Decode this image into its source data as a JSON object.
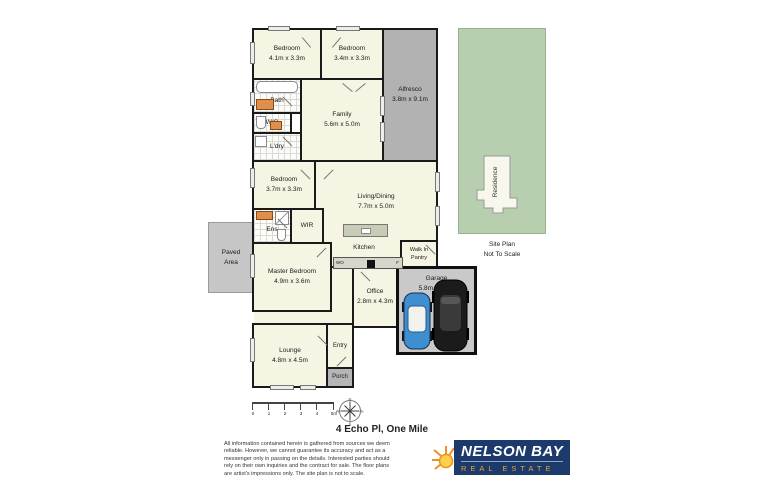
{
  "title": "4 Echo Pl, One Mile",
  "rooms": {
    "bedroom_top_left": {
      "name": "Bedroom",
      "dims": "4.1m x 3.3m"
    },
    "bedroom_top_right": {
      "name": "Bedroom",
      "dims": "3.4m x 3.3m"
    },
    "bath": {
      "name": "Bath",
      "dims": ""
    },
    "wc": {
      "name": "W/C",
      "dims": ""
    },
    "laundry": {
      "name": "L'dry",
      "dims": ""
    },
    "family": {
      "name": "Family",
      "dims": "5.6m x 5.0m"
    },
    "alfresco": {
      "name": "Alfresco",
      "dims": "3.8m x 9.1m"
    },
    "bedroom_mid": {
      "name": "Bedroom",
      "dims": "3.7m x 3.3m"
    },
    "living_dining": {
      "name": "Living/Dining",
      "dims": "7.7m x 5.0m"
    },
    "ensuite": {
      "name": "Ens",
      "dims": ""
    },
    "wir": {
      "name": "WIR",
      "dims": ""
    },
    "paved_area": {
      "name": "Paved Area",
      "dims": ""
    },
    "master_bedroom": {
      "name": "Master Bedroom",
      "dims": "4.9m x 3.6m"
    },
    "kitchen": {
      "name": "Kitchen",
      "dims": ""
    },
    "walk_in_pantry": {
      "name": "Walk In Pantry",
      "dims": ""
    },
    "office": {
      "name": "Office",
      "dims": "2.8m x 4.3m"
    },
    "garage": {
      "name": "Garage",
      "dims": "5.8m x 5.7m"
    },
    "lounge": {
      "name": "Lounge",
      "dims": "4.8m x 4.5m"
    },
    "entry": {
      "name": "Entry",
      "dims": ""
    },
    "porch": {
      "name": "Porch",
      "dims": ""
    }
  },
  "kitchen_appliances": {
    "wall_oven": "WO",
    "fridge": "F"
  },
  "site_plan": {
    "residence": "Residence",
    "caption_line1": "Site Plan",
    "caption_line2": "Not To Scale"
  },
  "scale_bar": {
    "labels": [
      "0",
      "1",
      "2",
      "3",
      "4",
      "5m"
    ]
  },
  "compass": {
    "points": [
      "N",
      "E",
      "S",
      "W"
    ]
  },
  "footer": {
    "disclaimer": "All information contained herein is gathered from sources we deem reliable. However, we cannot guarantee its accuracy and act as a messenger only in passing on the details. Interested parties should rely on their own inquiries and the contract for sale. The floor plans are artist's impressions only. The site plan is not to scale."
  },
  "logo": {
    "name": "NELSON BAY",
    "tagline": "REAL ESTATE"
  },
  "colors": {
    "wall": "#1a1a1a",
    "room_fill": "#f6f5e4",
    "outdoor_gray": "#b2b2b2",
    "site_green": "#b7cfae",
    "logo_navy": "#1c3a6b",
    "logo_orange": "#f0a230",
    "car_blue": "#3f8ed0",
    "vanity_orange": "#dd8f4b"
  }
}
